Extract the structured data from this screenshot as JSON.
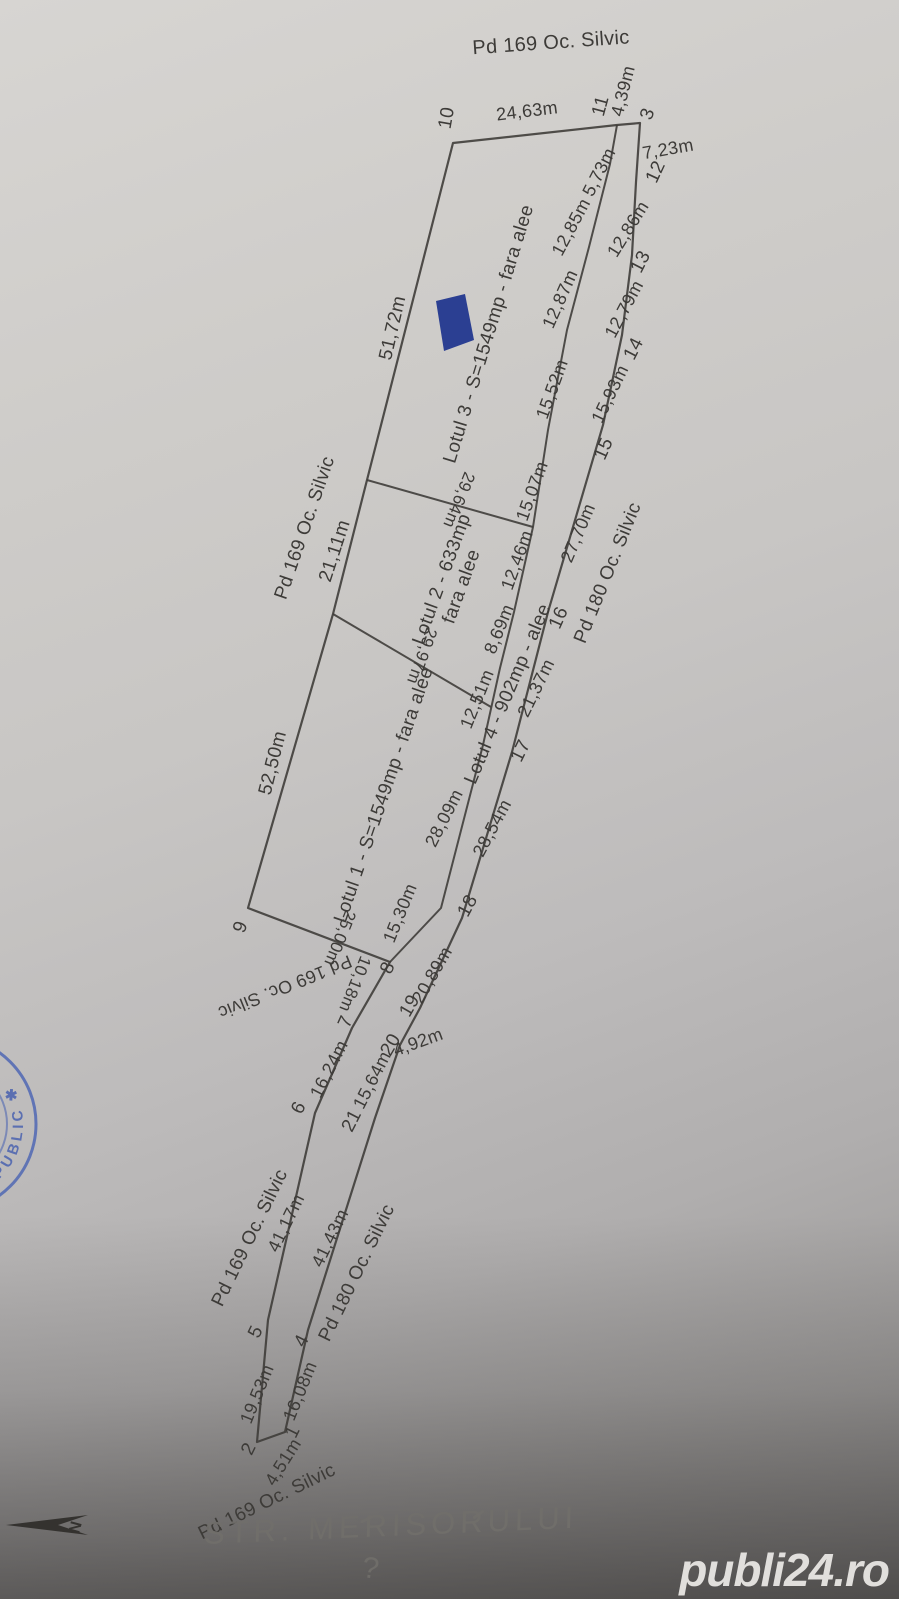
{
  "watermark": {
    "text": "publi24.ro"
  },
  "handwriting": {
    "street": "STR. MERISORULUI",
    "question_mark": "?"
  },
  "north_arrow": {
    "label": "N"
  },
  "stamp": {
    "arc_text": "R PUBLIC ✱"
  },
  "colors": {
    "ink": "#3f3d3a",
    "stamp_blue": "#4a62b0",
    "marker_blue": "#2b3f92",
    "paper_light": "#d7d5d2",
    "paper_dark": "#8a8887",
    "pencil_gray": "#716f6b",
    "watermark_white": "#eceae7"
  },
  "plan": {
    "lots": [
      {
        "name": "Lotul 1",
        "area": "S=1549mp",
        "note": "fara alee"
      },
      {
        "name": "Lotul 2",
        "area": "633mp",
        "note": "fara alee"
      },
      {
        "name": "Lotul 3",
        "area": "S=1549mp",
        "note": "fara alee"
      },
      {
        "name": "Lotul 4",
        "area": "902mp",
        "note": "alee"
      }
    ],
    "labels": [
      {
        "text": "Pd 169 Oc. Silvic",
        "kind": "pd",
        "x": 551,
        "y": 43,
        "rot": -4,
        "fs": 20
      },
      {
        "text": "Pd 169 Oc. Silvic",
        "kind": "pd",
        "x": 305,
        "y": 528,
        "rot": -71,
        "fs": 19
      },
      {
        "text": "Pd 169 Oc. Silvic",
        "kind": "pd",
        "x": 285,
        "y": 987,
        "rot": 158,
        "fs": 18
      },
      {
        "text": "Pd 169 Oc. Silvic",
        "kind": "pd",
        "x": 250,
        "y": 1238,
        "rot": -64,
        "fs": 19
      },
      {
        "text": "Pd 169 Oc. Silvic",
        "kind": "pd",
        "x": 267,
        "y": 1502,
        "rot": -26,
        "fs": 19
      },
      {
        "text": "Pd 180 Oc. Silvic",
        "kind": "pd",
        "x": 608,
        "y": 573,
        "rot": -68,
        "fs": 19
      },
      {
        "text": "Pd 180 Oc. Silvic",
        "kind": "pd",
        "x": 357,
        "y": 1273,
        "rot": -64,
        "fs": 19
      },
      {
        "text": "Lotul 3 - S=1549mp - fara alee",
        "kind": "lot",
        "x": 489,
        "y": 334,
        "rot": -73,
        "fs": 19
      },
      {
        "text": "Lotul 2 - 633mp\nfara alee",
        "kind": "lot",
        "x": 452,
        "y": 583,
        "rot": -70,
        "fs": 19
      },
      {
        "text": "Lotul 1 - S=1549mp - fara alee",
        "kind": "lot",
        "x": 384,
        "y": 795,
        "rot": -71,
        "fs": 19
      },
      {
        "text": "Lotul 4 - 902mp - alee",
        "kind": "lot",
        "x": 508,
        "y": 694,
        "rot": -67,
        "fs": 19
      },
      {
        "text": "10",
        "kind": "pt",
        "x": 447,
        "y": 118,
        "rot": -80,
        "fs": 19
      },
      {
        "text": "11",
        "kind": "pt",
        "x": 601,
        "y": 106,
        "rot": -75,
        "fs": 19
      },
      {
        "text": "3",
        "kind": "pt",
        "x": 648,
        "y": 114,
        "rot": -70,
        "fs": 19
      },
      {
        "text": "12",
        "kind": "pt",
        "x": 656,
        "y": 172,
        "rot": -65,
        "fs": 19
      },
      {
        "text": "13",
        "kind": "pt",
        "x": 641,
        "y": 262,
        "rot": -63,
        "fs": 19
      },
      {
        "text": "14",
        "kind": "pt",
        "x": 634,
        "y": 349,
        "rot": -63,
        "fs": 19
      },
      {
        "text": "15",
        "kind": "pt",
        "x": 604,
        "y": 449,
        "rot": -66,
        "fs": 19
      },
      {
        "text": "16",
        "kind": "pt",
        "x": 559,
        "y": 618,
        "rot": -66,
        "fs": 19
      },
      {
        "text": "17",
        "kind": "pt",
        "x": 521,
        "y": 751,
        "rot": -64,
        "fs": 19
      },
      {
        "text": "18",
        "kind": "pt",
        "x": 468,
        "y": 906,
        "rot": -62,
        "fs": 19
      },
      {
        "text": "19",
        "kind": "pt",
        "x": 410,
        "y": 1006,
        "rot": -60,
        "fs": 19
      },
      {
        "text": "20",
        "kind": "pt",
        "x": 391,
        "y": 1045,
        "rot": -60,
        "fs": 19
      },
      {
        "text": "21",
        "kind": "pt",
        "x": 352,
        "y": 1121,
        "rot": -63,
        "fs": 19
      },
      {
        "text": "9",
        "kind": "pt",
        "x": 241,
        "y": 927,
        "rot": -70,
        "fs": 19
      },
      {
        "text": "8",
        "kind": "pt",
        "x": 388,
        "y": 968,
        "rot": -66,
        "fs": 19
      },
      {
        "text": "7",
        "kind": "pt",
        "x": 346,
        "y": 1022,
        "rot": -66,
        "fs": 19
      },
      {
        "text": "6",
        "kind": "pt",
        "x": 299,
        "y": 1108,
        "rot": -63,
        "fs": 19
      },
      {
        "text": "5",
        "kind": "pt",
        "x": 256,
        "y": 1332,
        "rot": -64,
        "fs": 19
      },
      {
        "text": "4",
        "kind": "pt",
        "x": 302,
        "y": 1341,
        "rot": -64,
        "fs": 19
      },
      {
        "text": "2",
        "kind": "pt",
        "x": 249,
        "y": 1449,
        "rot": -64,
        "fs": 19
      },
      {
        "text": "1",
        "kind": "pt",
        "x": 293,
        "y": 1432,
        "rot": -64,
        "fs": 19
      },
      {
        "text": "24,63m",
        "kind": "dim",
        "x": 527,
        "y": 111,
        "rot": -7,
        "fs": 18
      },
      {
        "text": "4,39m",
        "kind": "dim",
        "x": 623,
        "y": 91,
        "rot": -76,
        "fs": 18
      },
      {
        "text": "7,23m",
        "kind": "dim",
        "x": 668,
        "y": 149,
        "rot": -10,
        "fs": 18
      },
      {
        "text": "5,73m",
        "kind": "dim",
        "x": 599,
        "y": 172,
        "rot": -63,
        "fs": 18
      },
      {
        "text": "12,85m",
        "kind": "dim",
        "x": 571,
        "y": 227,
        "rot": -62,
        "fs": 18
      },
      {
        "text": "12,86m",
        "kind": "dim",
        "x": 628,
        "y": 229,
        "rot": -58,
        "fs": 18
      },
      {
        "text": "12,87m",
        "kind": "dim",
        "x": 560,
        "y": 299,
        "rot": -66,
        "fs": 18
      },
      {
        "text": "12,79m",
        "kind": "dim",
        "x": 624,
        "y": 309,
        "rot": -62,
        "fs": 18
      },
      {
        "text": "15,52m",
        "kind": "dim",
        "x": 552,
        "y": 389,
        "rot": -70,
        "fs": 18
      },
      {
        "text": "15,93m",
        "kind": "dim",
        "x": 610,
        "y": 394,
        "rot": -64,
        "fs": 18
      },
      {
        "text": "15,07m",
        "kind": "dim",
        "x": 532,
        "y": 491,
        "rot": -70,
        "fs": 18
      },
      {
        "text": "29,64m",
        "kind": "dim",
        "x": 459,
        "y": 500,
        "rot": 112,
        "fs": 17
      },
      {
        "text": "51,72m",
        "kind": "dim",
        "x": 393,
        "y": 328,
        "rot": -77,
        "fs": 19
      },
      {
        "text": "21,11m",
        "kind": "dim",
        "x": 335,
        "y": 551,
        "rot": -72,
        "fs": 19
      },
      {
        "text": "27,70m",
        "kind": "dim",
        "x": 578,
        "y": 533,
        "rot": -67,
        "fs": 18
      },
      {
        "text": "12,46m",
        "kind": "dim",
        "x": 517,
        "y": 560,
        "rot": -70,
        "fs": 18
      },
      {
        "text": "8,69m",
        "kind": "dim",
        "x": 499,
        "y": 629,
        "rot": -68,
        "fs": 18
      },
      {
        "text": "29,97m",
        "kind": "dim",
        "x": 422,
        "y": 656,
        "rot": 110,
        "fs": 17
      },
      {
        "text": "12,51m",
        "kind": "dim",
        "x": 477,
        "y": 699,
        "rot": -68,
        "fs": 18
      },
      {
        "text": "21,37m",
        "kind": "dim",
        "x": 536,
        "y": 688,
        "rot": -64,
        "fs": 18
      },
      {
        "text": "28,09m",
        "kind": "dim",
        "x": 444,
        "y": 818,
        "rot": -63,
        "fs": 18
      },
      {
        "text": "28,54m",
        "kind": "dim",
        "x": 492,
        "y": 828,
        "rot": -62,
        "fs": 18
      },
      {
        "text": "52,50m",
        "kind": "dim",
        "x": 273,
        "y": 763,
        "rot": -76,
        "fs": 19
      },
      {
        "text": "15,30m",
        "kind": "dim",
        "x": 400,
        "y": 913,
        "rot": -68,
        "fs": 18
      },
      {
        "text": "25,00m",
        "kind": "dim",
        "x": 340,
        "y": 938,
        "rot": 112,
        "fs": 17
      },
      {
        "text": "10,18m",
        "kind": "dim",
        "x": 355,
        "y": 984,
        "rot": 112,
        "fs": 17
      },
      {
        "text": "20,89m",
        "kind": "dim",
        "x": 432,
        "y": 975,
        "rot": -60,
        "fs": 18
      },
      {
        "text": "4,92m",
        "kind": "dim",
        "x": 418,
        "y": 1042,
        "rot": -20,
        "fs": 18
      },
      {
        "text": "15,64m",
        "kind": "dim",
        "x": 372,
        "y": 1080,
        "rot": -63,
        "fs": 18
      },
      {
        "text": "16,24m",
        "kind": "dim",
        "x": 329,
        "y": 1069,
        "rot": -63,
        "fs": 18
      },
      {
        "text": "41,17m",
        "kind": "dim",
        "x": 286,
        "y": 1223,
        "rot": -64,
        "fs": 18
      },
      {
        "text": "41,43m",
        "kind": "dim",
        "x": 330,
        "y": 1238,
        "rot": -64,
        "fs": 18
      },
      {
        "text": "19,53m",
        "kind": "dim",
        "x": 257,
        "y": 1394,
        "rot": -68,
        "fs": 18
      },
      {
        "text": "16,08m",
        "kind": "dim",
        "x": 300,
        "y": 1391,
        "rot": -68,
        "fs": 18
      },
      {
        "text": "4,51m",
        "kind": "dim",
        "x": 283,
        "y": 1462,
        "rot": -58,
        "fs": 18
      }
    ]
  }
}
